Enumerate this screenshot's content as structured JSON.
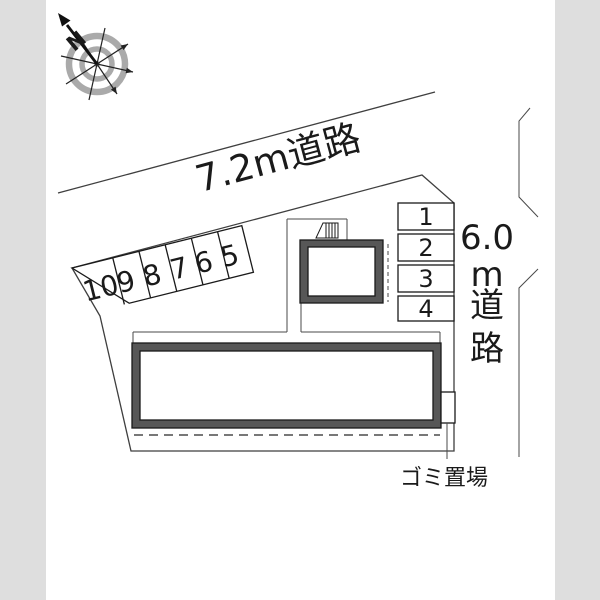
{
  "diagram": {
    "type": "real-estate site plan",
    "compass": {
      "north_label": "N"
    },
    "roads": {
      "top_label": "7.2m道路",
      "right_label_chars": [
        "6.0",
        "m",
        "道",
        "路"
      ]
    },
    "parking": {
      "diagonal_row": [
        "10",
        "9",
        "8",
        "7",
        "6",
        "5"
      ],
      "right_column": [
        "1",
        "2",
        "3",
        "4"
      ]
    },
    "labels": {
      "garbage": "ゴミ置場"
    },
    "colors": {
      "background": "#ffffff",
      "side_margin": "#dedede",
      "site_fill": "#ececec",
      "line": "#3f3f3f",
      "building_band": "#575757",
      "building_interior": "#ffffff",
      "compass_ring": "#aaaaaa",
      "text": "#1a1a1a"
    }
  }
}
